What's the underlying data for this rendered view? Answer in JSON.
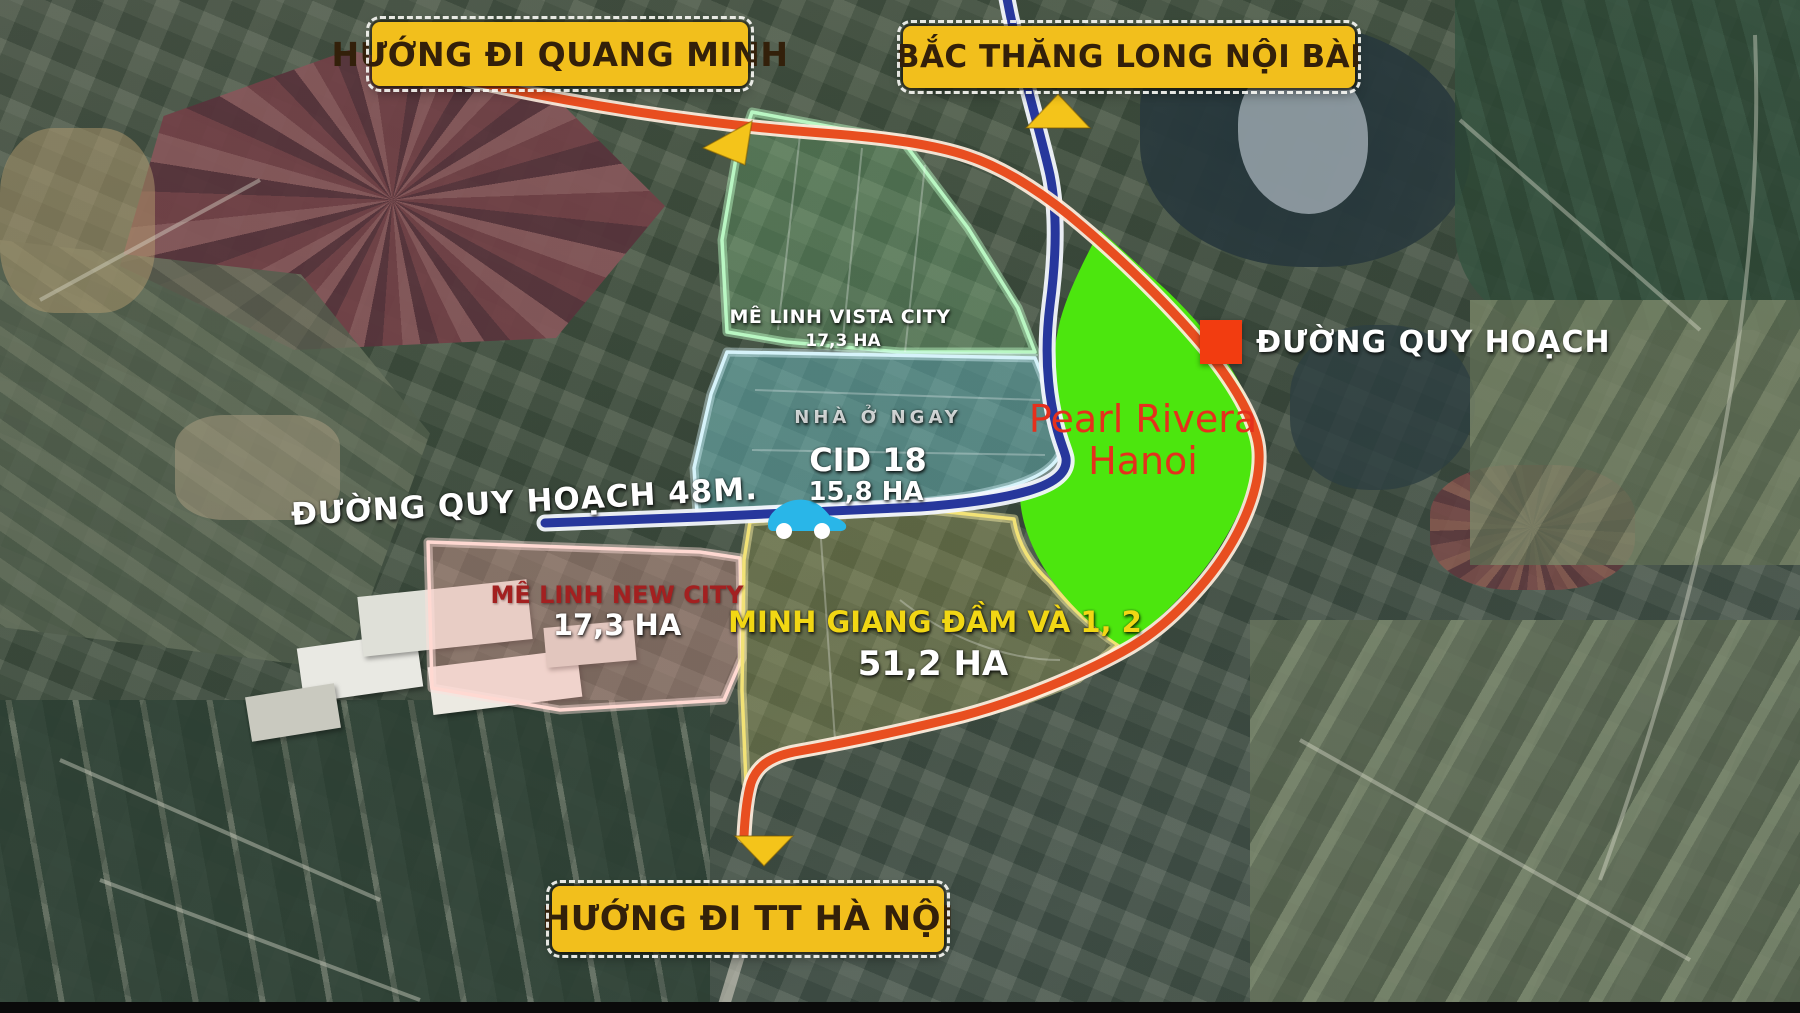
{
  "title": "Pearl Rivera Hanoi location map",
  "signs": {
    "quang_minh": "HƯỚNG ĐI QUANG MINH",
    "bac_thang_long": "BẮC THĂNG LONG NỘI BÀI",
    "tt_ha_noi": "HƯỚNG ĐI TT HÀ NỘI"
  },
  "legend": {
    "planned_road_label": "ĐƯỜNG QUY HOẠCH",
    "swatch_color": "#f23c10"
  },
  "roads": {
    "planned_48m_label": "ĐƯỜNG QUY HOẠCH 48M.",
    "orange_road_color": "#e84e20",
    "blue_road_color": "#27379c"
  },
  "project": {
    "name_line1": "Pearl Rivera",
    "name_line2": "Hanoi",
    "area_fill": "#4ce60e",
    "label_color": "#e5301c"
  },
  "areas": {
    "vista_city": {
      "name": "MÊ LINH VISTA CITY",
      "size": "17,3 HA",
      "outline": "#b9f7c3"
    },
    "cid18": {
      "note": "NHÀ Ở NGAY",
      "name": "CID 18",
      "size": "15,8 HA",
      "outline": "#d6f3fa"
    },
    "new_city": {
      "name": "MÊ LINH NEW CITY",
      "size": "17,3 HA",
      "outline": "#ffd9d2"
    },
    "minh_giang": {
      "name": "MINH GIANG ĐẦM VÀ 1, 2",
      "size": "51,2 HA",
      "outline": "#f2e276"
    }
  },
  "arrow_color": "#f4c41a",
  "sign_color": "#f2bf1c"
}
